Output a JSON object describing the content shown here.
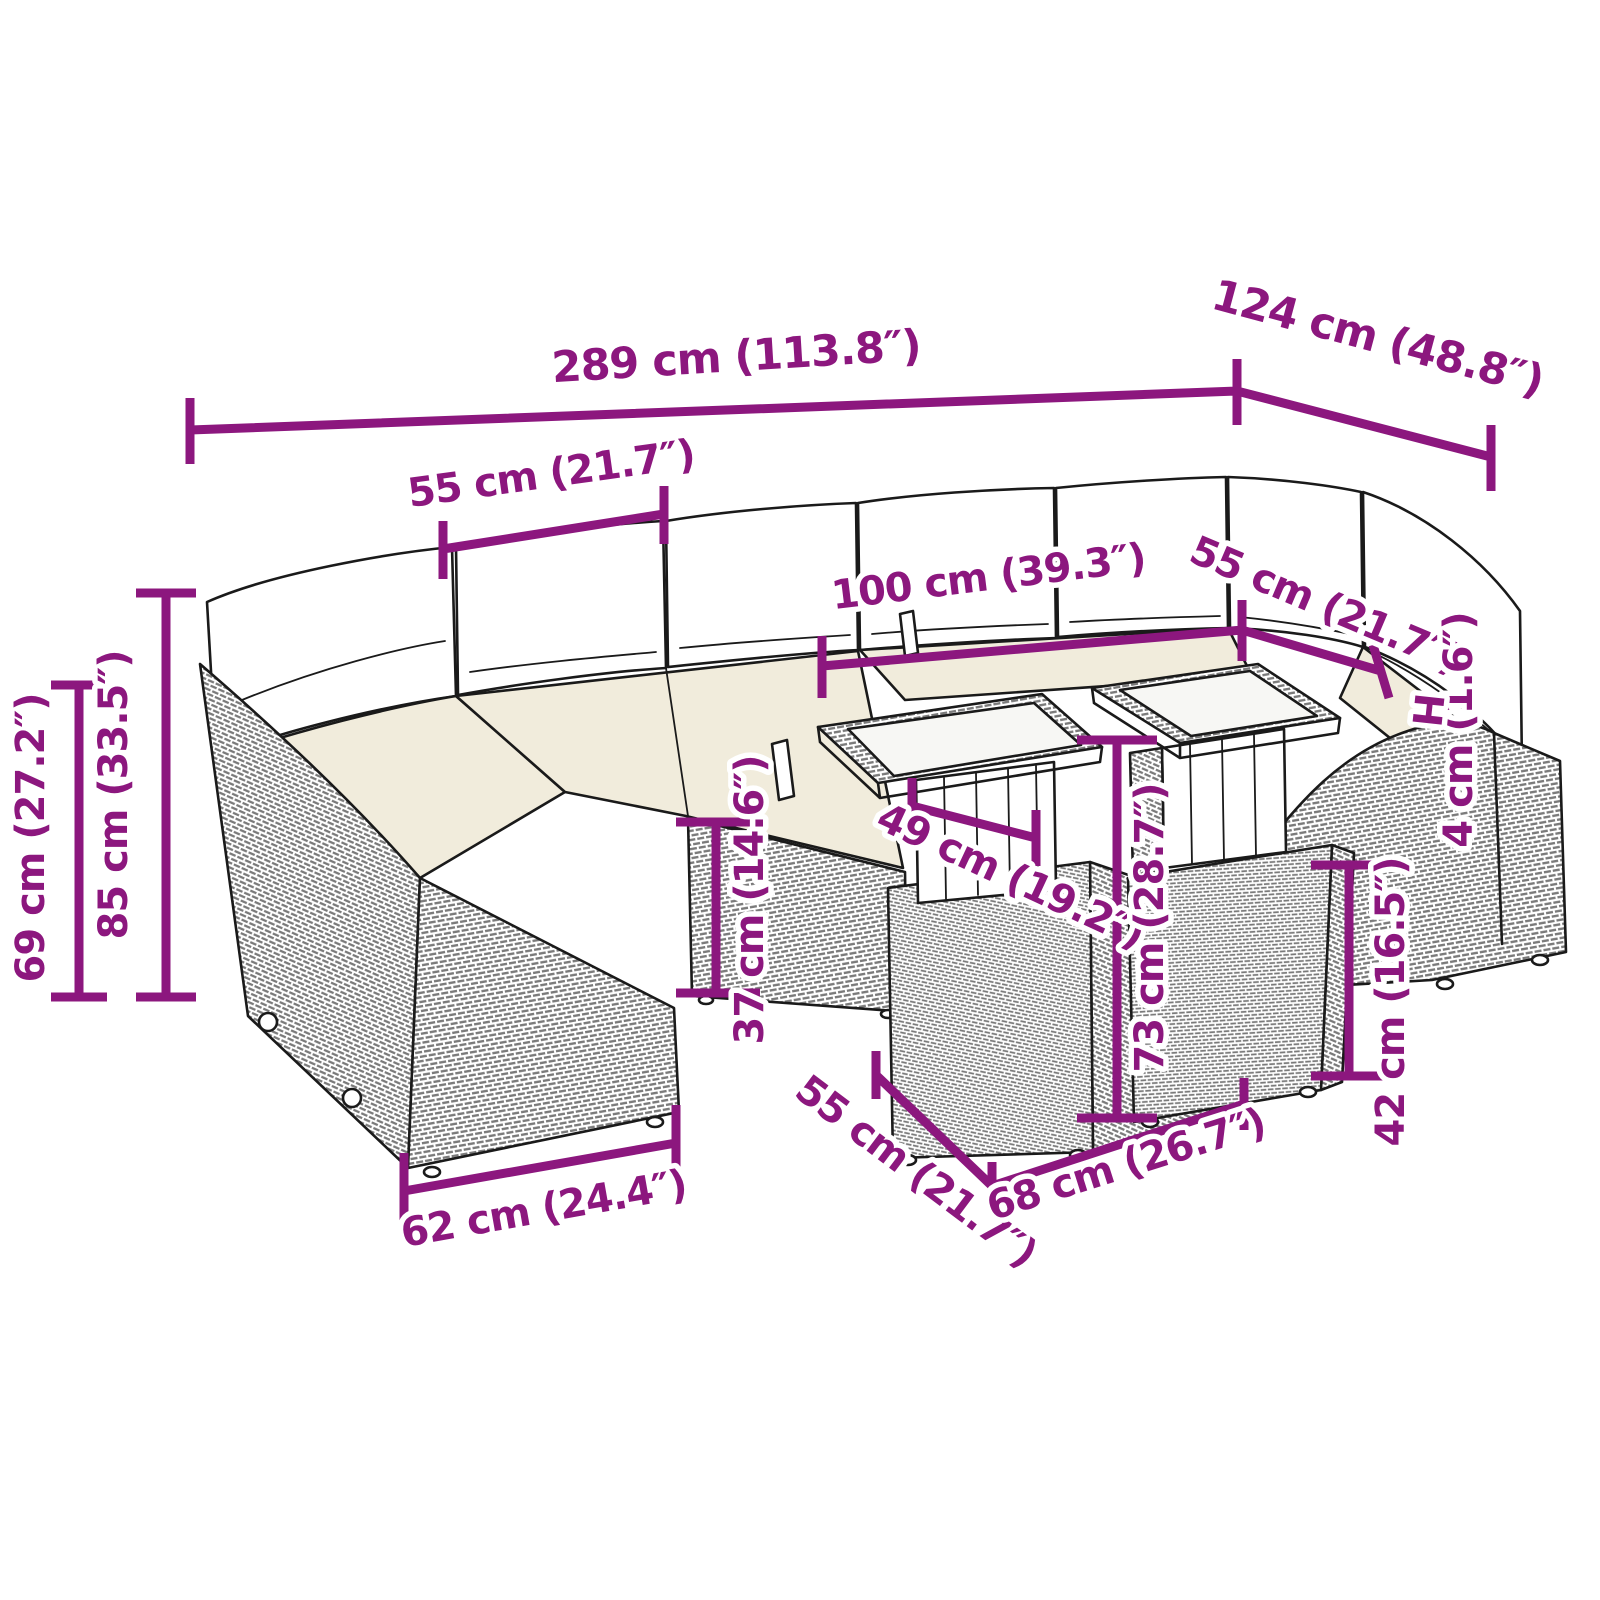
{
  "diagram": {
    "type": "product-dimension-line-drawing",
    "subject": "poly-rattan garden lounge set with glass-top tables",
    "background": "#ffffff"
  },
  "colors": {
    "dimension_accent": "#8C177E",
    "line_art": "#1a1a1a",
    "cushion_cream": "#f1ecdc",
    "pillow_white": "#ffffff",
    "glass": "#f7f7f4",
    "weave_gray": "#7a7a7a"
  },
  "dimensions": [
    {
      "name": "total-width",
      "label": "289 cm (113.8″)"
    },
    {
      "name": "total-depth",
      "label": "124 cm (48.8″)"
    },
    {
      "name": "module-top-width",
      "label": "55 cm (21.7″)"
    },
    {
      "name": "table-combined-width",
      "label": "100 cm (39.3″)"
    },
    {
      "name": "corner-module-width",
      "label": "55 cm (21.7″)"
    },
    {
      "name": "total-height",
      "label": "85 cm (33.5″)"
    },
    {
      "name": "armrest-height",
      "label": "69 cm (27.2″)"
    },
    {
      "name": "seat-height",
      "label": "37 cm (14.6″)"
    },
    {
      "name": "tabletop-depth",
      "label": "49 cm (19.2″)"
    },
    {
      "name": "table-height",
      "label": "73 cm (28.7″)"
    },
    {
      "name": "glass-top-thickness",
      "label": "4 cm (1.6″)"
    },
    {
      "name": "side-table-height",
      "label": "42 cm (16.5″)"
    },
    {
      "name": "module-depth",
      "label": "62 cm (24.4″)"
    },
    {
      "name": "table-base-depth",
      "label": "55 cm (21.7″)"
    },
    {
      "name": "table-base-width",
      "label": "68 cm (26.7″)"
    },
    {
      "name": "thickness-marker",
      "label": "H"
    }
  ]
}
